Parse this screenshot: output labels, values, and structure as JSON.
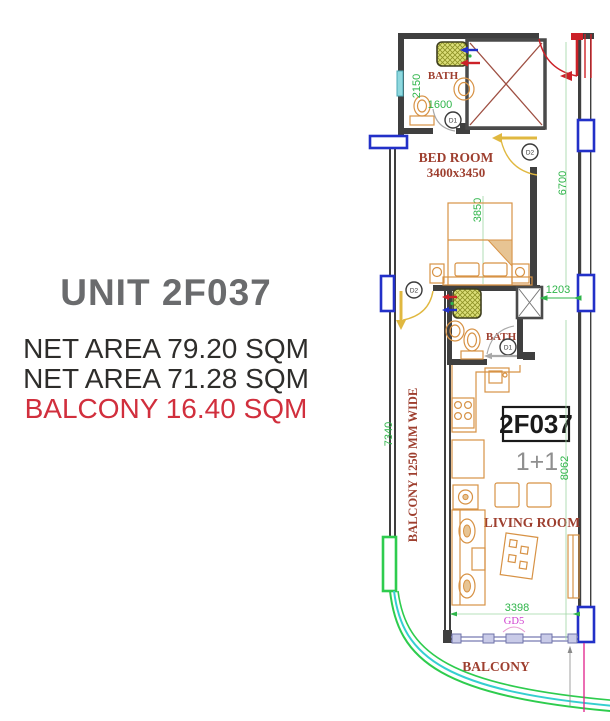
{
  "side_panel": {
    "title": "UNIT 2F037",
    "lines": [
      {
        "text": "NET AREA 79.20 SQM",
        "color": "#2e2d2b"
      },
      {
        "text": "NET AREA 71.28 SQM",
        "color": "#2e2d2b"
      },
      {
        "text": "BALCONY 16.40 SQM",
        "color": "#d12f3d"
      }
    ]
  },
  "floor_plan": {
    "unit_box": {
      "number": "2F037",
      "type": "1+1"
    },
    "rooms": {
      "bath_upper": {
        "label": "BATH"
      },
      "bed_room": {
        "label": "BED ROOM",
        "size": "3400x3450"
      },
      "bath_lower": {
        "label": "BATH"
      },
      "living_room": {
        "label": "LIVING ROOM"
      },
      "balcony_bottom": {
        "label": "BALCONY"
      },
      "balcony_side": {
        "label": "BALCONY 1250 MM WIDE"
      }
    },
    "doors": {
      "d1_upper": "D1",
      "d2_bedroom": "D2",
      "d2_balcony": "D2",
      "d1_lower": "D1"
    },
    "dimensions": {
      "bath_width": "2150",
      "bath_length": "1600",
      "bedroom_length": "3850",
      "right_side_upper": "6700",
      "passage_width": "1203",
      "right_side_lower": "8062",
      "balcony_length": "7340",
      "living_width": "3398"
    },
    "door_tag": "GD5",
    "colors": {
      "walls": "#3f3f3f",
      "dimension_green": "#2fb54a",
      "room_label_brown": "#9e3f2f",
      "furniture_orange": "#d79245",
      "window_blue": "#2230c8",
      "entry_door_red": "#cc2128",
      "interior_door_yellow": "#e0b840",
      "balcony_green": "#2ecc4e",
      "balcony_cyan": "#35cfd0",
      "gd5_magenta": "#cf3ecf",
      "unit_type_gray": "#8f8f8f",
      "teal_window": "#8fd8de",
      "title_gray": "#6a6b6d",
      "area_text": "#2e2d2b",
      "balcony_text_red": "#d12f3d"
    }
  }
}
